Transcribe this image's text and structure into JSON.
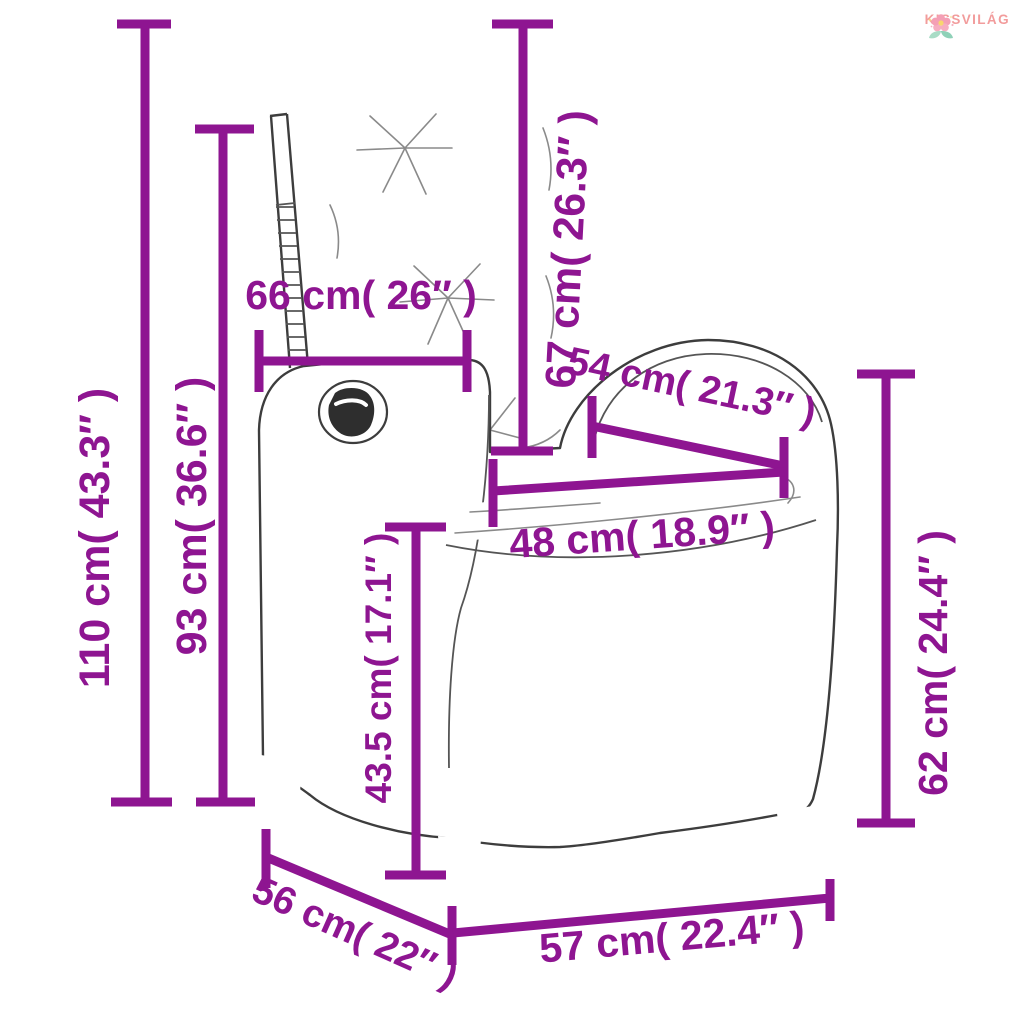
{
  "page": {
    "background": "#ffffff"
  },
  "brand": {
    "name": "KISSVILÁG",
    "text_color": "#f29c9c"
  },
  "diagram": {
    "subject": "reclining rattan garden chair with cushions",
    "accent_color": "#8e1591",
    "dimensions": [
      {
        "id": "total-height",
        "label": "110 cm( 43.3″ )"
      },
      {
        "id": "backrest-height",
        "label": "93 cm( 36.6″ )"
      },
      {
        "id": "backrest-width",
        "label": "66 cm( 26″ )"
      },
      {
        "id": "back-cushion-height",
        "label": "67 cm( 26.3″ )"
      },
      {
        "id": "armrest-depth",
        "label": "54 cm( 21.3″ )"
      },
      {
        "id": "seat-width",
        "label": "48 cm( 18.9″ )"
      },
      {
        "id": "seat-height",
        "label": "43.5 cm( 17.1″ )"
      },
      {
        "id": "armrest-height",
        "label": "62 cm( 24.4″ )"
      },
      {
        "id": "depth",
        "label": "56 cm( 22″ )"
      },
      {
        "id": "width",
        "label": "57 cm( 22.4″ )"
      }
    ]
  }
}
